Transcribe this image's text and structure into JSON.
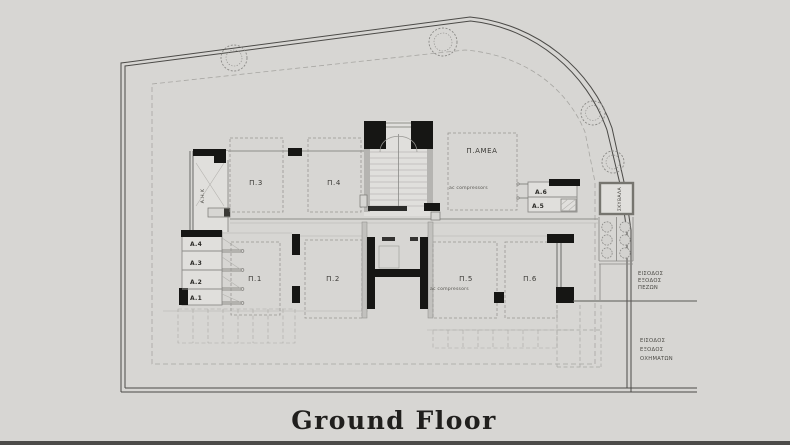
{
  "title": "Ground Floor",
  "colors": {
    "background": "#d7d6d3",
    "boundary": "#4b4a47",
    "walls_black": "#161614",
    "building_gray": "#8e8d8a",
    "room_fill": "#e0dfdc"
  },
  "parking": {
    "p1": "Π.1",
    "p2": "Π.2",
    "p3": "Π.3",
    "p4": "Π.4",
    "p5": "Π.5",
    "p6": "Π.6",
    "accessible": "Π.ΑΜΕΑ"
  },
  "storage": {
    "a1": "A.1",
    "a2": "A.2",
    "a3": "A.3",
    "a4": "A.4",
    "a5": "A.5",
    "a6": "A.6"
  },
  "rooms": {
    "electrical": "Α.Η.Κ",
    "garbage": "ΣΚΥΒΑΛΑ"
  },
  "notes": {
    "ac_upper": "ac compressors",
    "ac_lower": "ac compressors"
  },
  "entrances": {
    "pedestrian": {
      "line1": "ΕΙΣΟΔΟΣ",
      "line2": "ΕΞΟΔΟΣ",
      "line3": "ΠΕΖΩΝ"
    },
    "vehicle": {
      "line1": "ΕΙΣΟΔΟΣ",
      "line2": "ΕΞΟΔΟΣ",
      "line3": "ΟΧΗΜΑΤΩΝ"
    }
  }
}
